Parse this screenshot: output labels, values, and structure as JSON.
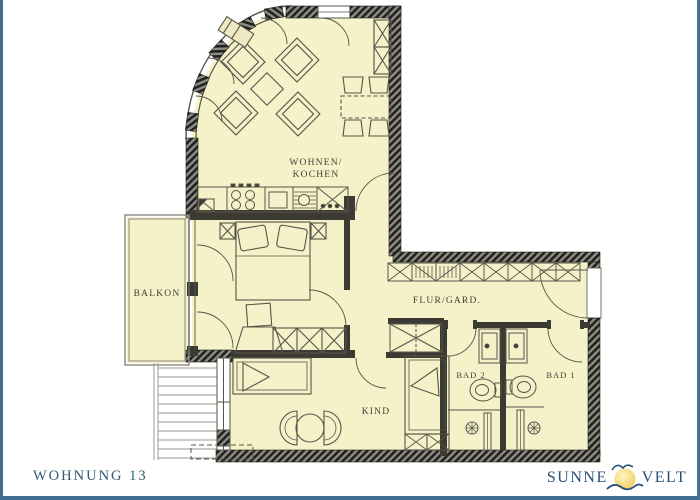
{
  "floorplan": {
    "labels": {
      "living_line1": "WOHNEN/",
      "living_line2": "KOCHEN",
      "balcony": "BALKON",
      "hall": "FLUR/GARD.",
      "bath2": "BAD 2",
      "bath1": "BAD 1",
      "child": "KIND"
    },
    "colors": {
      "floor": "#f5f1c9",
      "wall_dark": "#33332e",
      "line": "#56554a",
      "label_text": "#3f3e33"
    }
  },
  "footer": {
    "apartment_label": "WOHNUNG 13",
    "brand_left": "SUNNE",
    "brand_right": "VELT",
    "brand_color": "#27507b",
    "sun_color": "#eec84e",
    "frame_color": "#3f6d92"
  }
}
